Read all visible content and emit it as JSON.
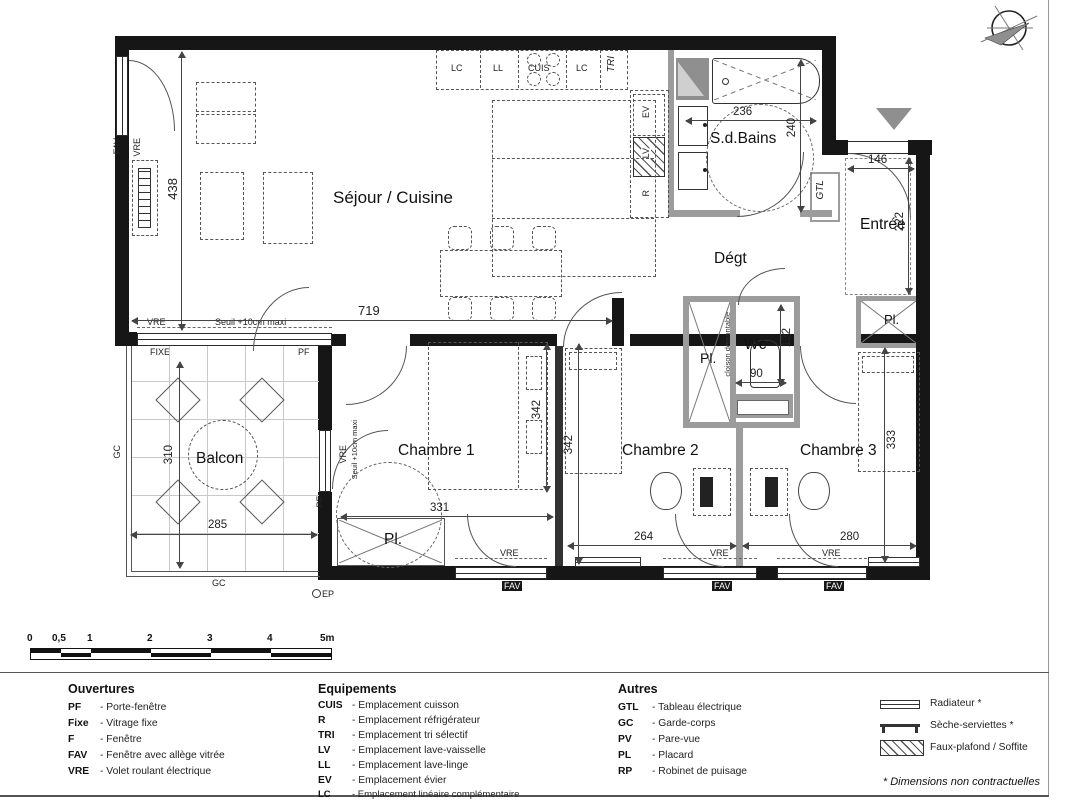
{
  "compass": {
    "north_letter": "N"
  },
  "rooms": {
    "sejour": "Séjour / Cuisine",
    "sdbains": "S.d.Bains",
    "entree": "Entrée",
    "degt": "Dégt",
    "wc": "Wc",
    "chambre1": "Chambre 1",
    "chambre2": "Chambre 2",
    "chambre3": "Chambre 3",
    "balcon": "Balcon"
  },
  "dims": {
    "sejour_h": "438",
    "sejour_w": "719",
    "sdb_w": "236",
    "sdb_h": "240",
    "entree_w": "146",
    "entree_h": "222",
    "wc_h": "132",
    "wc_w": "90",
    "ch1_h": "342",
    "ch1_w": "331",
    "ch2_h": "342",
    "ch2_w": "264",
    "ch3_w": "280",
    "ch3_h": "333",
    "balcon_w": "285",
    "balcon_h": "310"
  },
  "tags": {
    "pf": "PF",
    "fixe": "FIXE",
    "fav": "FAV",
    "vre": "VRE",
    "gc": "GC",
    "gtl": "GTL",
    "ep": "EP",
    "pl": "Pl.",
    "seuil": "Seuil +10cm maxi",
    "cloison": "cloison démontable"
  },
  "kitchen": {
    "lc": "LC",
    "ll": "LL",
    "cuis": "CUIS",
    "tri": "TRI",
    "ev": "EV",
    "lv": "LV",
    "r": "R"
  },
  "scalebar": {
    "ticks": [
      "0",
      "0,5",
      "1",
      "2",
      "3",
      "4",
      "5m"
    ]
  },
  "legend": {
    "ouvertures": {
      "title": "Ouvertures",
      "items": [
        {
          "abbr": "PF",
          "label": "- Porte-fenêtre"
        },
        {
          "abbr": "Fixe",
          "label": "- Vitrage fixe"
        },
        {
          "abbr": "F",
          "label": "- Fenêtre"
        },
        {
          "abbr": "FAV",
          "label": "- Fenêtre avec allège vitrée"
        },
        {
          "abbr": "VRE",
          "label": "- Volet roulant électrique"
        }
      ]
    },
    "equipements": {
      "title": "Equipements",
      "items": [
        {
          "abbr": "CUIS",
          "label": "- Emplacement  cuisson"
        },
        {
          "abbr": "R",
          "label": "- Emplacement réfrigérateur"
        },
        {
          "abbr": "TRI",
          "label": "- Emplacement tri sélectif"
        },
        {
          "abbr": "LV",
          "label": "- Emplacement lave-vaisselle"
        },
        {
          "abbr": "LL",
          "label": "- Emplacement lave-linge"
        },
        {
          "abbr": "EV",
          "label": "- Emplacement évier"
        },
        {
          "abbr": "LC",
          "label": "- Emplacement linéaire complémentaire"
        }
      ]
    },
    "autres": {
      "title": "Autres",
      "items": [
        {
          "abbr": "GTL",
          "label": "- Tableau électrique"
        },
        {
          "abbr": "GC",
          "label": "- Garde-corps"
        },
        {
          "abbr": "PV",
          "label": "- Pare-vue"
        },
        {
          "abbr": "PL",
          "label": "- Placard"
        },
        {
          "abbr": "RP",
          "label": "- Robinet de puisage"
        }
      ]
    },
    "symbols": [
      {
        "name": "radiateur",
        "label": "Radiateur *"
      },
      {
        "name": "seche-serviettes",
        "label": "Sèche-serviettes *"
      },
      {
        "name": "faux-plafond",
        "label": "Faux-plafond / Soffite"
      }
    ],
    "footnote": "* Dimensions non contractuelles"
  }
}
